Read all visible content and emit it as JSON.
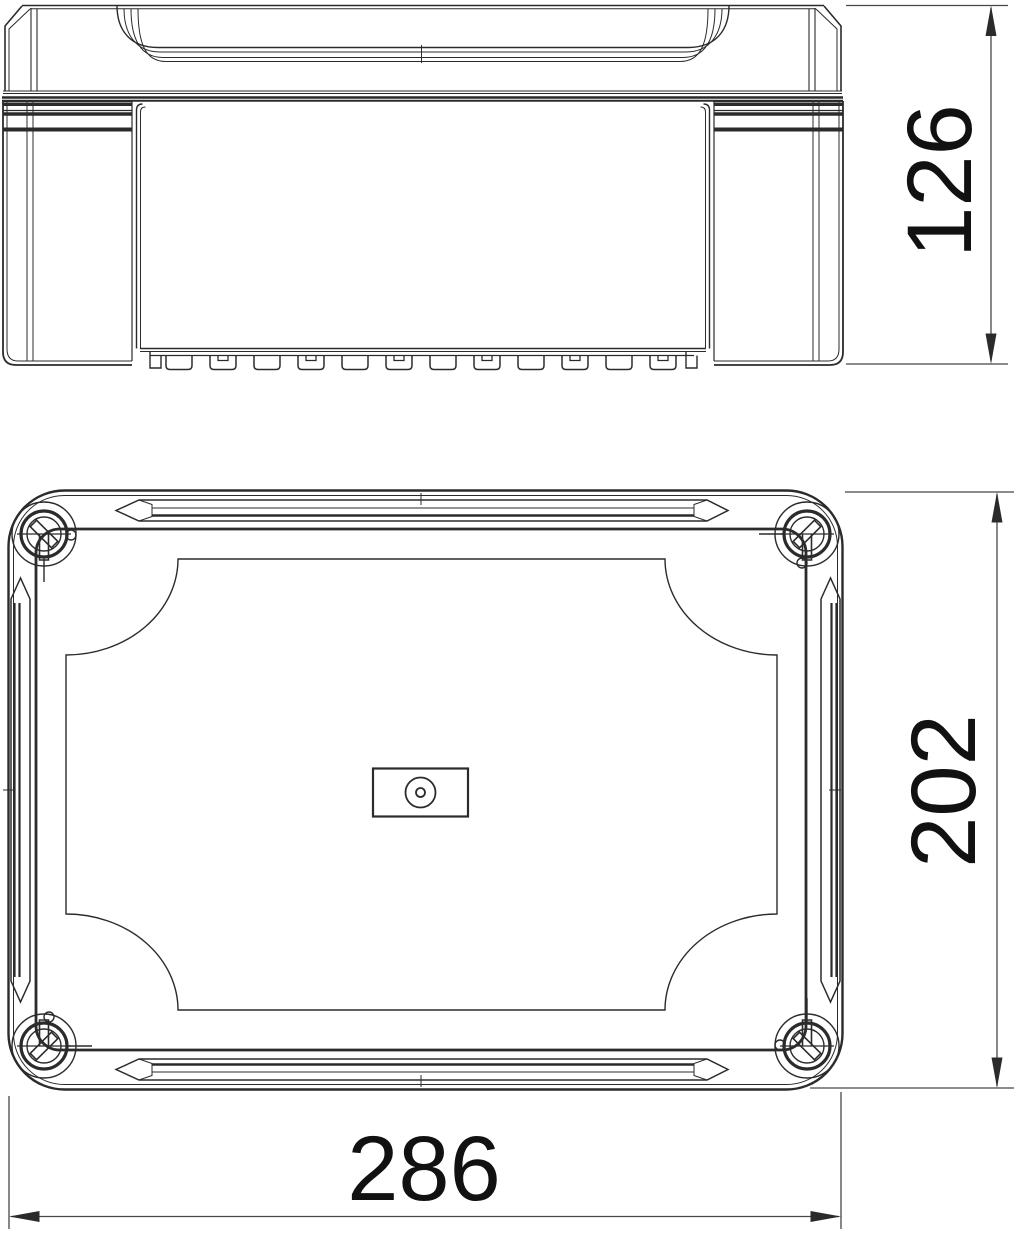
{
  "dimensions": {
    "height": "126",
    "depth": "202",
    "width": "286"
  },
  "colors": {
    "line": "#2b2b2b",
    "dimension_line": "#474747",
    "text": "#111111",
    "background": "#ffffff"
  }
}
